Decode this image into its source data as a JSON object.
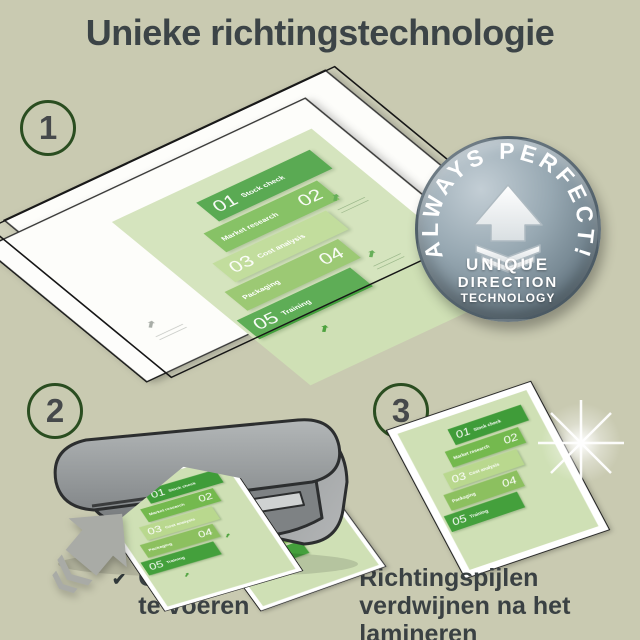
{
  "title": "Unieke richtingstechnologie",
  "steps": [
    {
      "number": "1"
    },
    {
      "number": "2"
    },
    {
      "number": "3"
    }
  ],
  "badge": {
    "arc_text": "ALWAYS PERFECT!",
    "line1": "UNIQUE",
    "line2": "DIRECTION",
    "line3": "TECHNOLOGY"
  },
  "infographic": {
    "launch": "Launch",
    "rows": [
      {
        "num": "01",
        "label": "Stock check"
      },
      {
        "num": "02",
        "label": "Market research"
      },
      {
        "num": "03",
        "label": "Cost analysis"
      },
      {
        "num": "04",
        "label": "Packaging"
      },
      {
        "num": "05",
        "label": "Training"
      }
    ]
  },
  "checklist": {
    "items": [
      {
        "text": "Gemakkelijk in te voeren"
      },
      {
        "text": "Richtingspijlen verdwijnen na het lamineren"
      }
    ]
  },
  "icons": {
    "check": "✔",
    "arrow_ne": "⬈",
    "badge_arrow": "up-arrow-with-chevrons",
    "feed_arrow": "up-right-arrow-with-chevrons"
  },
  "colors": {
    "background": "#c9cab1",
    "title_text": "#3c4447",
    "step_circle_ring": "#2a4d20",
    "badge_base": "#8b9ca8",
    "badge_rim": "#4a5a64",
    "green_dark": "#3f9c39",
    "green_mid": "#74b94e",
    "green_light": "#b9d88e",
    "green_pale": "#cfe0b5",
    "machine_gray": "#8a8e8f",
    "arrow_gray": "#a9aba6",
    "pouch_white": "#ffffff"
  }
}
